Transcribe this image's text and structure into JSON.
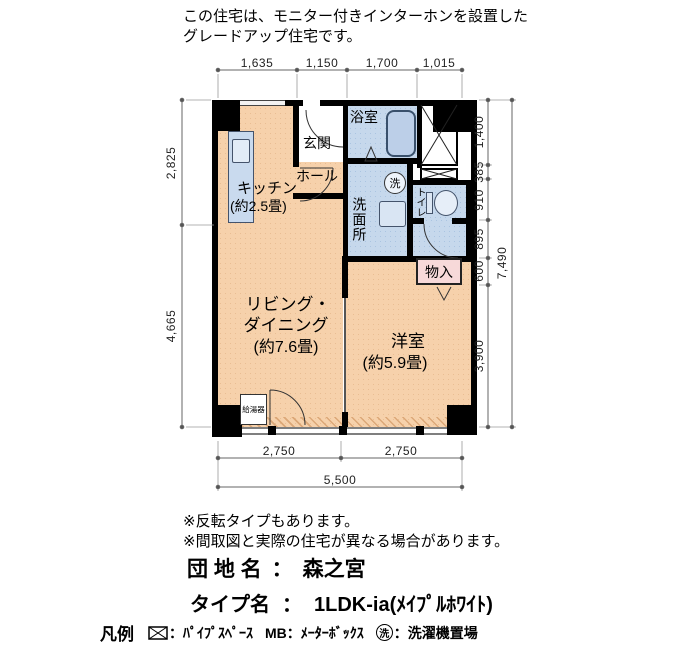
{
  "header": {
    "line1": "この住宅は、モニター付きインターホンを設置した",
    "line2": "グレードアップ住宅です。"
  },
  "plan": {
    "rooms": {
      "kitchen": "キッチン",
      "kitchen_size": "(約2.5畳)",
      "genkan": "玄関",
      "hall": "ホール",
      "bath": "浴室",
      "washer_symbol": "洗",
      "sanitary": "洗面所",
      "toilet": "トイレ",
      "storage": "物入",
      "living_line1": "リビング・",
      "living_line2": "ダイニング",
      "living_size": "(約7.6畳)",
      "western": "洋室",
      "western_size": "(約5.9畳)",
      "heater": "給湯器"
    },
    "dims": {
      "top": [
        "1,635",
        "1,150",
        "1,700",
        "1,015"
      ],
      "left": [
        "2,825",
        "4,665"
      ],
      "right": [
        "1,400",
        "385",
        "910",
        "895",
        "600",
        "3,900"
      ],
      "right_total": "7,490",
      "bottom": [
        "2,750",
        "2,750"
      ],
      "bottom_total": "5,500"
    }
  },
  "notes": [
    "※反転タイプもあります。",
    "※間取図と実際の住宅が異なる場合があります。"
  ],
  "estate": {
    "label": "団 地 名",
    "sep": "：",
    "value": "森之宮"
  },
  "type": {
    "label": "タイプ名",
    "sep": "：",
    "value": "1LDK-ia(ﾒｲﾌﾟﾙﾎﾜｲﾄ)"
  },
  "legend": {
    "title": "凡例",
    "ps_label": "：ﾊﾟｲﾌﾟｽﾍﾟｰｽ",
    "mb_symbol": "MB",
    "mb_label": "：ﾒｰﾀｰﾎﾞｯｸｽ",
    "wash_symbol": "洗",
    "wash_label": "：洗濯機置場"
  },
  "colors": {
    "room_orange": "#f6d1ab",
    "wet_blue": "#c6d8ec",
    "storage_pink": "#f7d9d9",
    "wall": "#000000"
  }
}
